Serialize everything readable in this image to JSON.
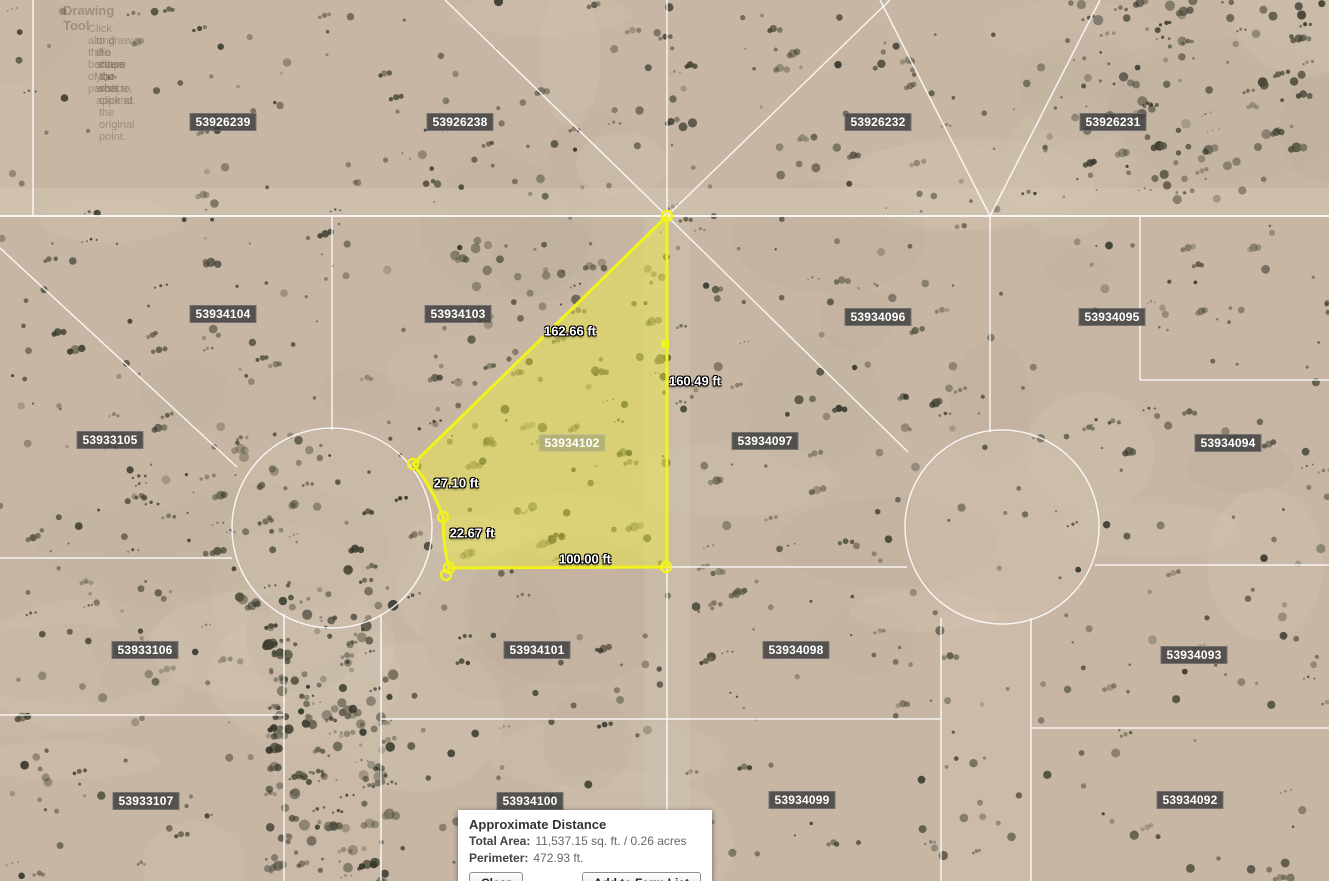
{
  "map": {
    "watermark": {
      "title": "Drawing Tool",
      "line1": "Click along the borders of the parcel",
      "line2": "to draw the shape you wish to append.",
      "line3": "To close the shape, click at the original point."
    },
    "parcel_labels": [
      {
        "id": "53926239",
        "x": 223,
        "y": 122,
        "highlighted": false
      },
      {
        "id": "53926238",
        "x": 460,
        "y": 122,
        "highlighted": false
      },
      {
        "id": "53926232",
        "x": 878,
        "y": 122,
        "highlighted": false
      },
      {
        "id": "53926231",
        "x": 1113,
        "y": 122,
        "highlighted": false
      },
      {
        "id": "53934104",
        "x": 223,
        "y": 314,
        "highlighted": false
      },
      {
        "id": "53934103",
        "x": 458,
        "y": 314,
        "highlighted": false
      },
      {
        "id": "53934096",
        "x": 878,
        "y": 317,
        "highlighted": false
      },
      {
        "id": "53934095",
        "x": 1112,
        "y": 317,
        "highlighted": false
      },
      {
        "id": "53933105",
        "x": 110,
        "y": 440,
        "highlighted": false
      },
      {
        "id": "53934102",
        "x": 572,
        "y": 443,
        "highlighted": true
      },
      {
        "id": "53934097",
        "x": 765,
        "y": 441,
        "highlighted": false
      },
      {
        "id": "53934094",
        "x": 1228,
        "y": 443,
        "highlighted": false
      },
      {
        "id": "53933106",
        "x": 145,
        "y": 650,
        "highlighted": false
      },
      {
        "id": "53934101",
        "x": 537,
        "y": 650,
        "highlighted": false
      },
      {
        "id": "53934098",
        "x": 796,
        "y": 650,
        "highlighted": false
      },
      {
        "id": "53934093",
        "x": 1194,
        "y": 655,
        "highlighted": false
      },
      {
        "id": "53933107",
        "x": 146,
        "y": 801,
        "highlighted": false
      },
      {
        "id": "53934100",
        "x": 530,
        "y": 801,
        "highlighted": false
      },
      {
        "id": "53934099",
        "x": 802,
        "y": 800,
        "highlighted": false
      },
      {
        "id": "53934092",
        "x": 1190,
        "y": 800,
        "highlighted": false
      }
    ],
    "measurements": [
      {
        "text": "162.66 ft",
        "x": 570,
        "y": 331
      },
      {
        "text": "160.49 ft",
        "x": 695,
        "y": 381
      },
      {
        "text": "27.10 ft",
        "x": 456,
        "y": 483
      },
      {
        "text": "22.67 ft",
        "x": 472,
        "y": 533
      },
      {
        "text": "100.00 ft",
        "x": 585,
        "y": 559
      }
    ],
    "selected_parcel_id": "53934102",
    "highlight_color": "#f2f21c"
  },
  "panel": {
    "title": "Approximate Distance",
    "total_area_label": "Total Area:",
    "total_area_value": "11,537.15 sq. ft. / 0.26 acres",
    "perimeter_label": "Perimeter:",
    "perimeter_value": "472.93 ft.",
    "clear_button": "Clear",
    "add_button": "Add to Farm List"
  }
}
